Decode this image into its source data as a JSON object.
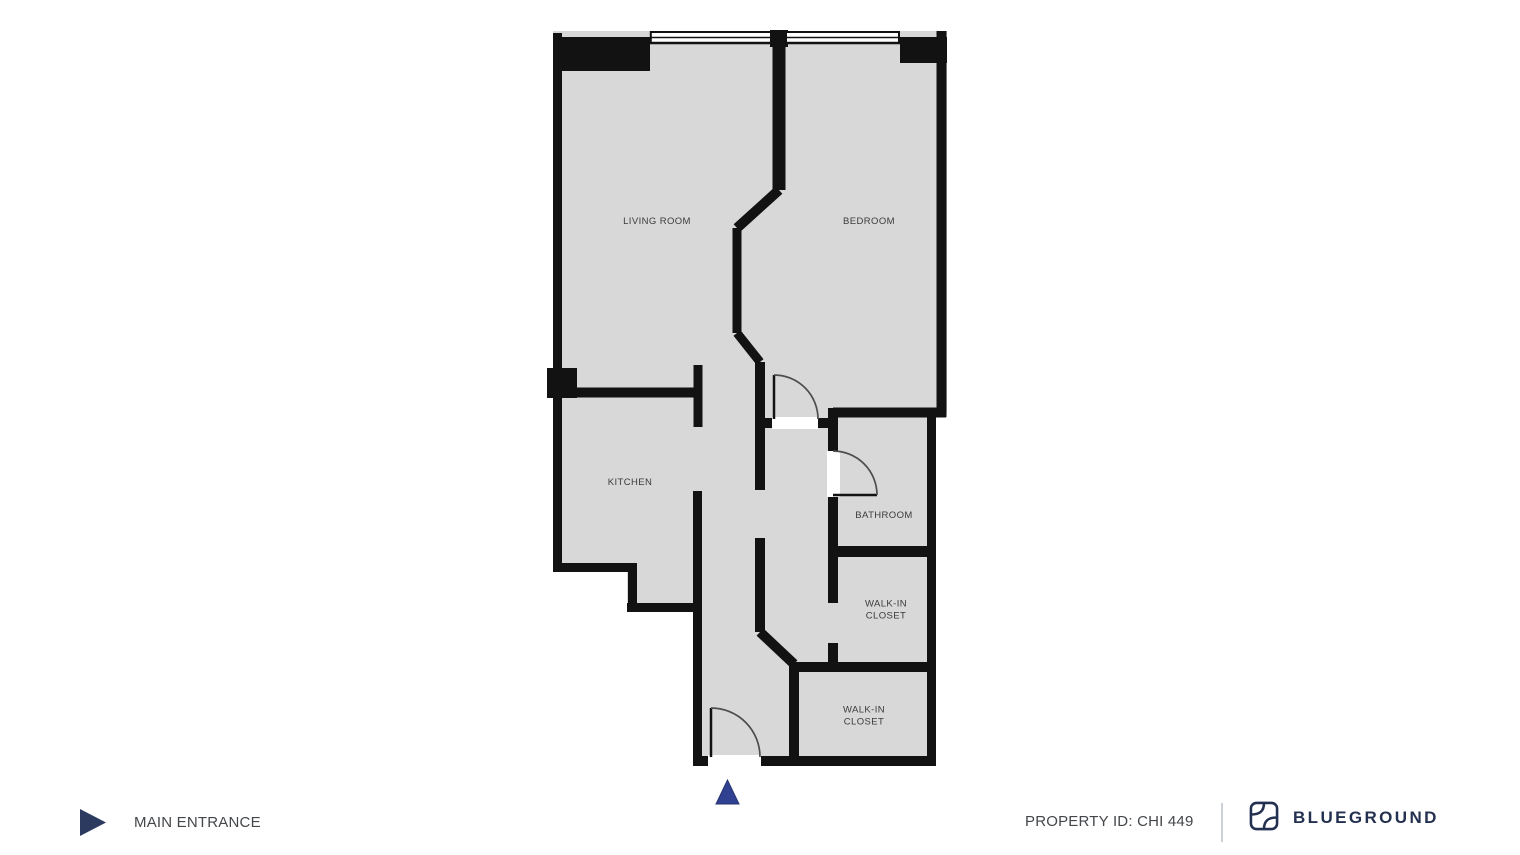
{
  "floorplan": {
    "wall_color": "#121212",
    "floor_color": "#d8d8d8",
    "door_arc_color": "#4d4d4d",
    "label_color": "#3b3b3b",
    "entrance_marker_color": "#2f4190",
    "rooms": [
      {
        "id": "living-room",
        "label": "LIVING ROOM"
      },
      {
        "id": "bedroom",
        "label": "BEDROOM"
      },
      {
        "id": "kitchen",
        "label": "KITCHEN"
      },
      {
        "id": "bathroom",
        "label": "BATHROOM"
      },
      {
        "id": "walk-in-closet-1",
        "label": "WALK-IN CLOSET"
      },
      {
        "id": "walk-in-closet-2",
        "label": "WALK-IN CLOSET"
      }
    ]
  },
  "footer": {
    "main_entrance_label": "MAIN ENTRANCE",
    "property_id": "PROPERTY ID: CHI 449",
    "brand": "BLUEGROUND",
    "brand_color": "#233050",
    "text_color": "#43464a",
    "play_icon_color": "#2b3a5e"
  }
}
